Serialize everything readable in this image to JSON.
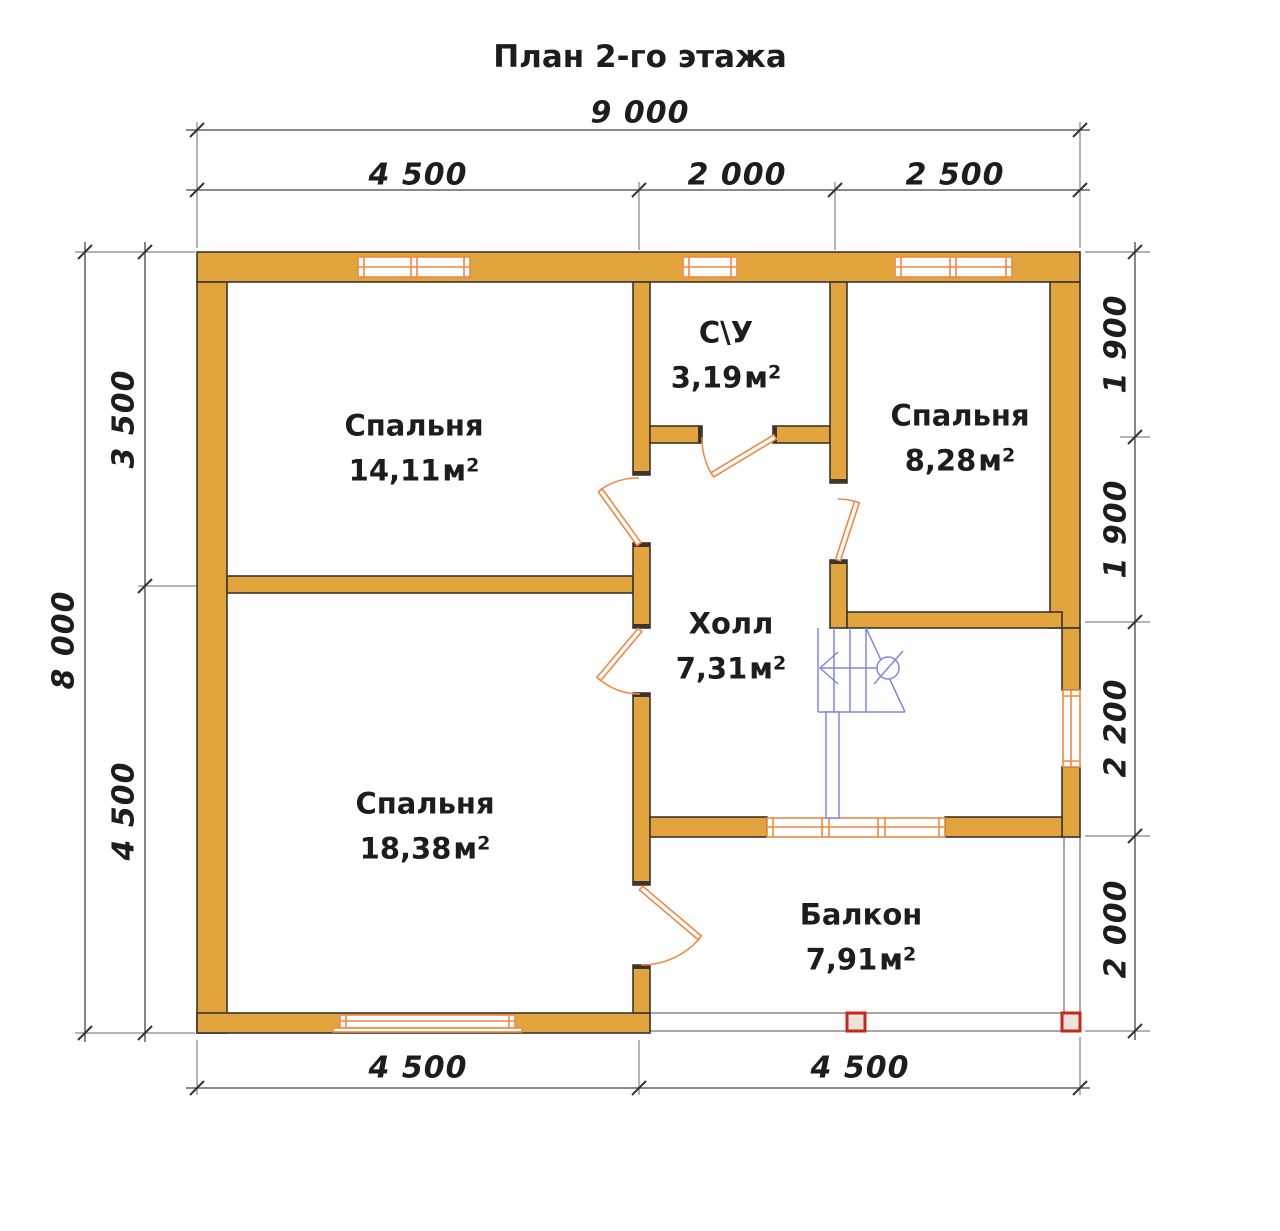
{
  "title": "План 2-го этажа",
  "rooms": [
    {
      "name": "Спальня",
      "area": "14,11"
    },
    {
      "name": "С\\У",
      "area": "3,19"
    },
    {
      "name": "Спальня",
      "area": "8,28"
    },
    {
      "name": "Холл",
      "area": "7,31"
    },
    {
      "name": "Спальня",
      "area": "18,38"
    },
    {
      "name": "Балкон",
      "area": "7,91"
    }
  ],
  "units": {
    "m": "м",
    "sup": "2"
  },
  "dimensions": {
    "top_total": "9 000",
    "top_segments": [
      "4 500",
      "2 000",
      "2 500"
    ],
    "left_total": "8 000",
    "left_segments": [
      "3 500",
      "4 500"
    ],
    "right_segments": [
      "1 900",
      "1 900",
      "2 200",
      "2 000"
    ],
    "bottom_segments": [
      "4 500",
      "4 500"
    ]
  },
  "colors": {
    "wall": "#e2a43c",
    "line": "#3b352e",
    "frame": "#f08843",
    "stair": "#8087e2",
    "column": "#cb251c",
    "colfill": "#ece4da",
    "dim": "#444444",
    "text": "#1d1d1d"
  }
}
